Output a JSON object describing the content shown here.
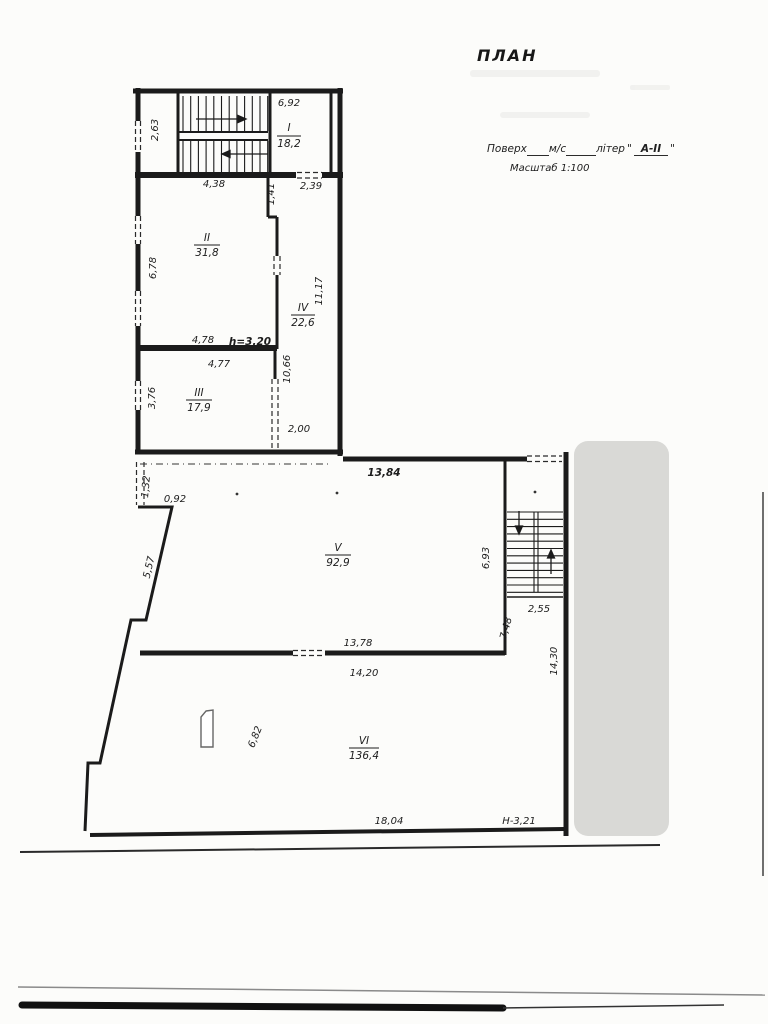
{
  "header": {
    "title": "ПЛАН",
    "form_floor_label": "Поверх",
    "form_ms_label": "м/с",
    "form_liter_label": "літер",
    "form_quote_open": "\"",
    "form_liter_value": "А-ІІ",
    "form_quote_close": "\"",
    "scale": "Масштаб 1:100"
  },
  "rooms": [
    {
      "num": "I",
      "area": "18,2"
    },
    {
      "num": "II",
      "area": "31,8"
    },
    {
      "num": "III",
      "area": "17,9"
    },
    {
      "num": "IV",
      "area": "22,6"
    },
    {
      "num": "V",
      "area": "92,9"
    },
    {
      "num": "VI",
      "area": "136,4"
    }
  ],
  "dims": {
    "top_width": "6,92",
    "stair_left_h": "2,63",
    "room2_top": "4,38",
    "niche_w": "1,41",
    "door_top": "2,39",
    "left_mid_h": "6,78",
    "corridor_len": "11,17",
    "room2_bottom": "4,78",
    "ceiling_height": "h=3,20",
    "room3_top": "4,77",
    "corridor_low": "10,66",
    "left_low_h": "3,76",
    "corridor_bottom": "2,00",
    "hall_top": "13,84",
    "left_stub": "1,32",
    "left_step": "0,92",
    "slant_wall": "5,57",
    "stair2_h": "6,93",
    "stair2_w": "2,55",
    "landing_h": "7,48",
    "right_side_h": "14,30",
    "hall_bottom": "13,78",
    "room6_top": "14,20",
    "room6_h": "6,82",
    "room6_bottom": "18,04",
    "level_mark": "Н-3,21"
  }
}
